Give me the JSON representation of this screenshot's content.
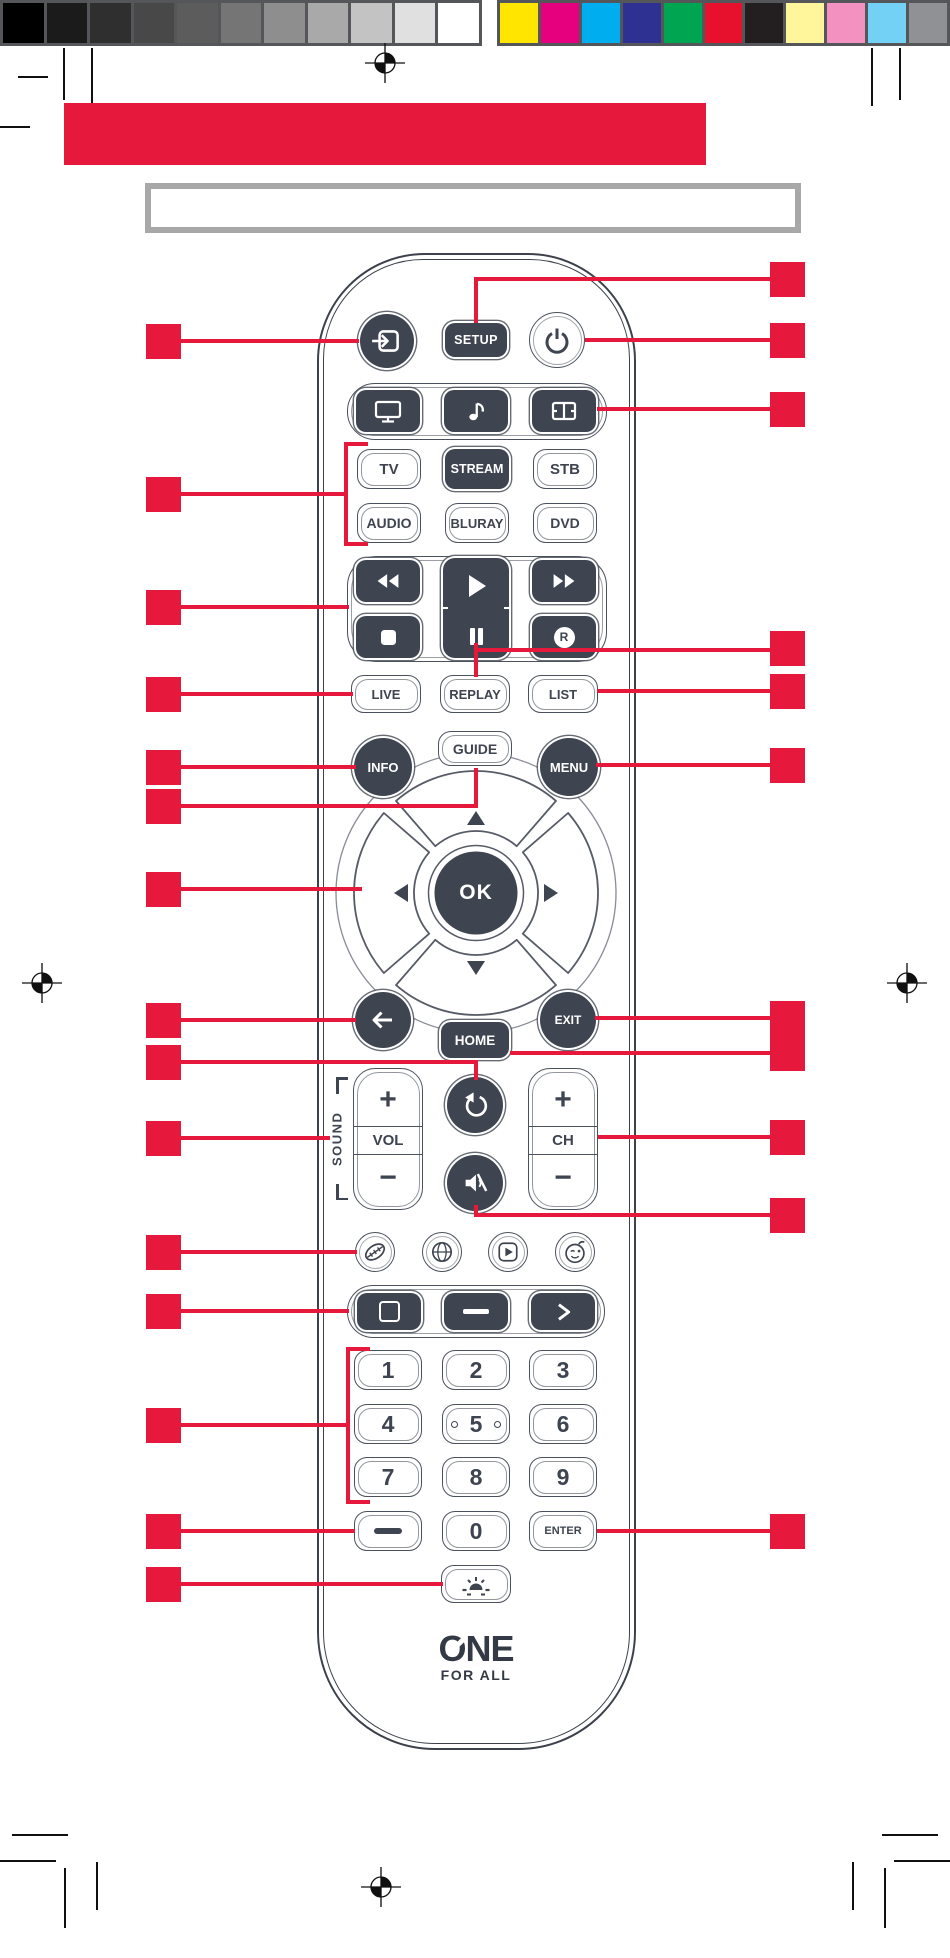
{
  "document_type": "remote-control-manual-diagram",
  "accent": {
    "callout_red": "#e6193c",
    "button_dark": "#3e4450",
    "box_gray": "#a8a8a8"
  },
  "print_bar": {
    "gray_swatches": [
      "#000000",
      "#1b1b1b",
      "#2f2f2f",
      "#484848",
      "#5c5c5c",
      "#757575",
      "#8e8e8e",
      "#a9a9a9",
      "#c3c3c3",
      "#e0e0e0",
      "#ffffff"
    ],
    "color_swatches": [
      "#ffe500",
      "#e6007e",
      "#00aeef",
      "#2e3192",
      "#00a551",
      "#e8112d",
      "#231f20",
      "#fff59b",
      "#f391c1",
      "#74d1f6",
      "#8f9194"
    ]
  },
  "title_box_text": "",
  "labels": {
    "setup": "SETUP",
    "devices": [
      "TV",
      "STREAM",
      "STB",
      "AUDIO",
      "BLURAY",
      "DVD"
    ],
    "record": "R",
    "live": "LIVE",
    "replay": "REPLAY",
    "list": "LIST",
    "guide": "GUIDE",
    "info": "INFO",
    "menu": "MENU",
    "ok": "OK",
    "home": "HOME",
    "exit": "EXIT",
    "sound": "SOUND",
    "vol": "VOL",
    "ch": "CH",
    "plus": "+",
    "minus": "−",
    "digits": [
      "1",
      "2",
      "3",
      "4",
      "5",
      "6",
      "7",
      "8",
      "9"
    ],
    "zero": "0",
    "enter": "ENTER",
    "brand_line1": "ONE",
    "brand_line2": "FOR ALL"
  },
  "icons": [
    "input-source-icon",
    "power-icon",
    "tv-mode-icon",
    "music-mode-icon",
    "movie-mode-icon",
    "rewind-icon",
    "play-icon",
    "pause-icon",
    "fast-forward-icon",
    "stop-icon",
    "record-icon",
    "up-triangle-icon",
    "down-triangle-icon",
    "left-triangle-icon",
    "right-triangle-icon",
    "back-arrow-icon",
    "undo-icon",
    "mute-icon",
    "leaf-icon",
    "globe-icon",
    "video-app-icon",
    "kids-face-icon",
    "picture-format-icon",
    "dash-icon",
    "chevron-next-icon",
    "keypad-dash-icon",
    "backlight-icon",
    "registration-mark",
    "crop-mark",
    "one-for-all-logo"
  ]
}
